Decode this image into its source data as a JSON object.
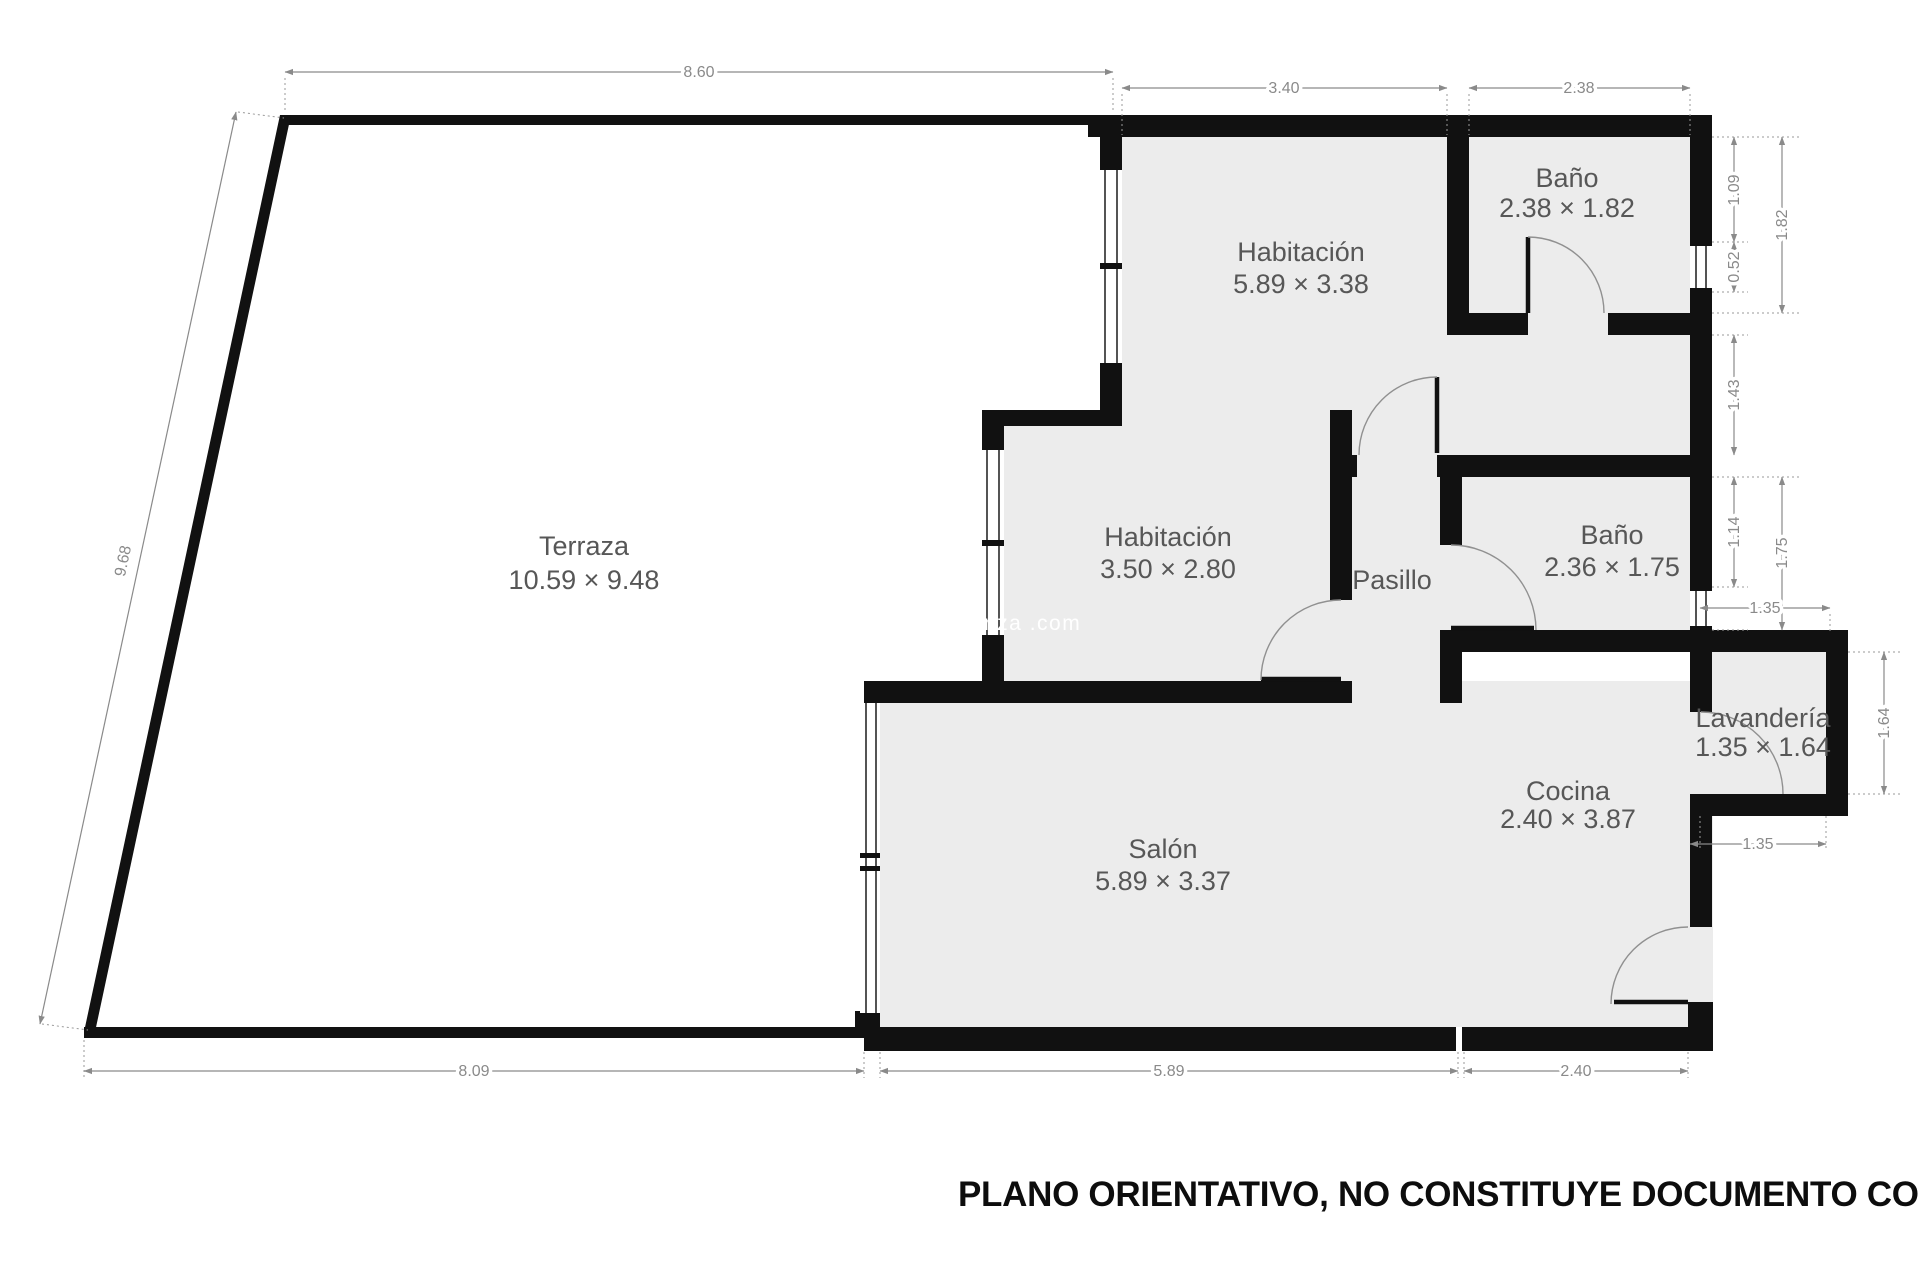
{
  "colors": {
    "wall": "#111111",
    "room_fill": "#ececec",
    "dim": "#8a8a8a",
    "label": "#575757",
    "watermark": "#ffffff",
    "disclaimer": "#0d0d0d"
  },
  "rooms": {
    "terraza": {
      "name": "Terraza",
      "size": "10.59 × 9.48"
    },
    "habitacion1": {
      "name": "Habitación",
      "size": "5.89 × 3.38"
    },
    "bano1": {
      "name": "Baño",
      "size": "2.38 × 1.82"
    },
    "habitacion2": {
      "name": "Habitación",
      "size": "3.50 × 2.80"
    },
    "pasillo": {
      "name": "Pasillo"
    },
    "bano2": {
      "name": "Baño",
      "size": "2.36 × 1.75"
    },
    "lavanderia": {
      "name": "Lavandería",
      "size": "1.35 × 1.64"
    },
    "cocina": {
      "name": "Cocina",
      "size": "2.40 × 3.87"
    },
    "salon": {
      "name": "Salón",
      "size": "5.89 × 3.37"
    }
  },
  "dimensions": {
    "top_terraza": "8.60",
    "top_habitacion": "3.40",
    "top_bano": "2.38",
    "right_bano1_upper": "1.09",
    "right_bano1_total": "1.82",
    "right_bano1_window": "0.52",
    "right_gap": "1.43",
    "right_bano2_upper": "1.14",
    "right_bano2_total": "1.75",
    "lavanderia_top": "1.35",
    "lavanderia_right": "1.64",
    "lavanderia_bottom": "1.35",
    "left_terraza": "9.68",
    "bottom_terraza": "8.09",
    "bottom_salon": "5.89",
    "bottom_cocina": "2.40"
  },
  "watermark": "nza .com",
  "disclaimer": "PLANO ORIENTATIVO, NO CONSTITUYE DOCUMENTO CONTRACTUAL"
}
